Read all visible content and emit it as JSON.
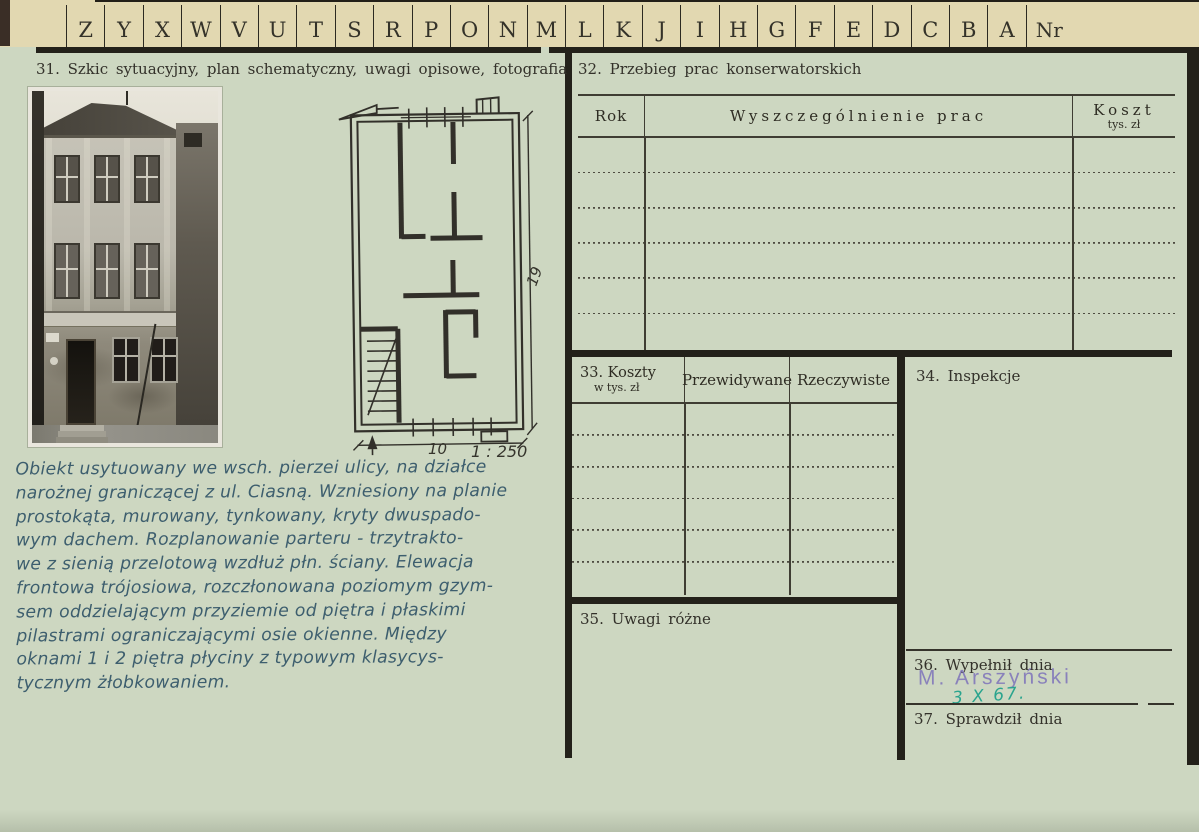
{
  "tabs": {
    "letters": [
      "Z",
      "Y",
      "X",
      "W",
      "V",
      "U",
      "T",
      "S",
      "R",
      "P",
      "O",
      "N",
      "M",
      "L",
      "K",
      "J",
      "I",
      "H",
      "G",
      "F",
      "E",
      "D",
      "C",
      "B",
      "A"
    ],
    "nr": "Nr"
  },
  "s31": {
    "title": "31. Szkic sytuacyjny, plan schematyczny, uwagi opisowe, fotografia",
    "plan": {
      "height_dim": "19",
      "width_dim": "10",
      "scale": "1 : 250"
    },
    "notes": [
      "Obiekt usytuowany we wsch. pierzei ulicy, na działce",
      "narożnej graniczącej z ul. Ciasną. Wzniesiony na planie",
      "prostokąta, murowany, tynkowany, kryty dwuspado-",
      "wym dachem. Rozplanowanie parteru - trzytrakto-",
      "we z sienią przelotową wzdłuż płn. ściany. Elewacja",
      "frontowa trójosiowa, rozczłonowana poziomym gzym-",
      "sem oddzielającym przyziemie od piętra i płaskimi",
      "pilastrami ograniczającymi osie okienne. Między",
      "oknami 1 i 2 piętra płyciny z typowym klasycys-",
      "tycznym żłobkowaniem."
    ]
  },
  "s32": {
    "title": "32. Przebieg prac konserwatorskich",
    "col_rok": "Rok",
    "col_prace": "Wyszczególnienie prac",
    "col_koszt": "Koszt",
    "col_koszt_sub": "tys. zł"
  },
  "s33": {
    "title": "33. Koszty",
    "title_sub": "w tys. zł",
    "col_przewidywane": "Przewidywane",
    "col_rzeczywiste": "Rzeczywiste"
  },
  "s34": {
    "title": "34. Inspekcje"
  },
  "s35": {
    "title": "35. Uwagi różne"
  },
  "s36": {
    "title": "36. Wypełnił dnia",
    "stamp": "M. Arszyński",
    "date": "3 X 67."
  },
  "s37": {
    "title": "37. Sprawdził dnia"
  },
  "colors": {
    "card_green": "#cdd7c1",
    "tab_cream": "#e2d8b1",
    "print_ink": "#2e2c23",
    "handwriting_ink": "#3d5e6e",
    "stamp_purple": "#7c72ba",
    "date_teal": "#2aa48e"
  }
}
